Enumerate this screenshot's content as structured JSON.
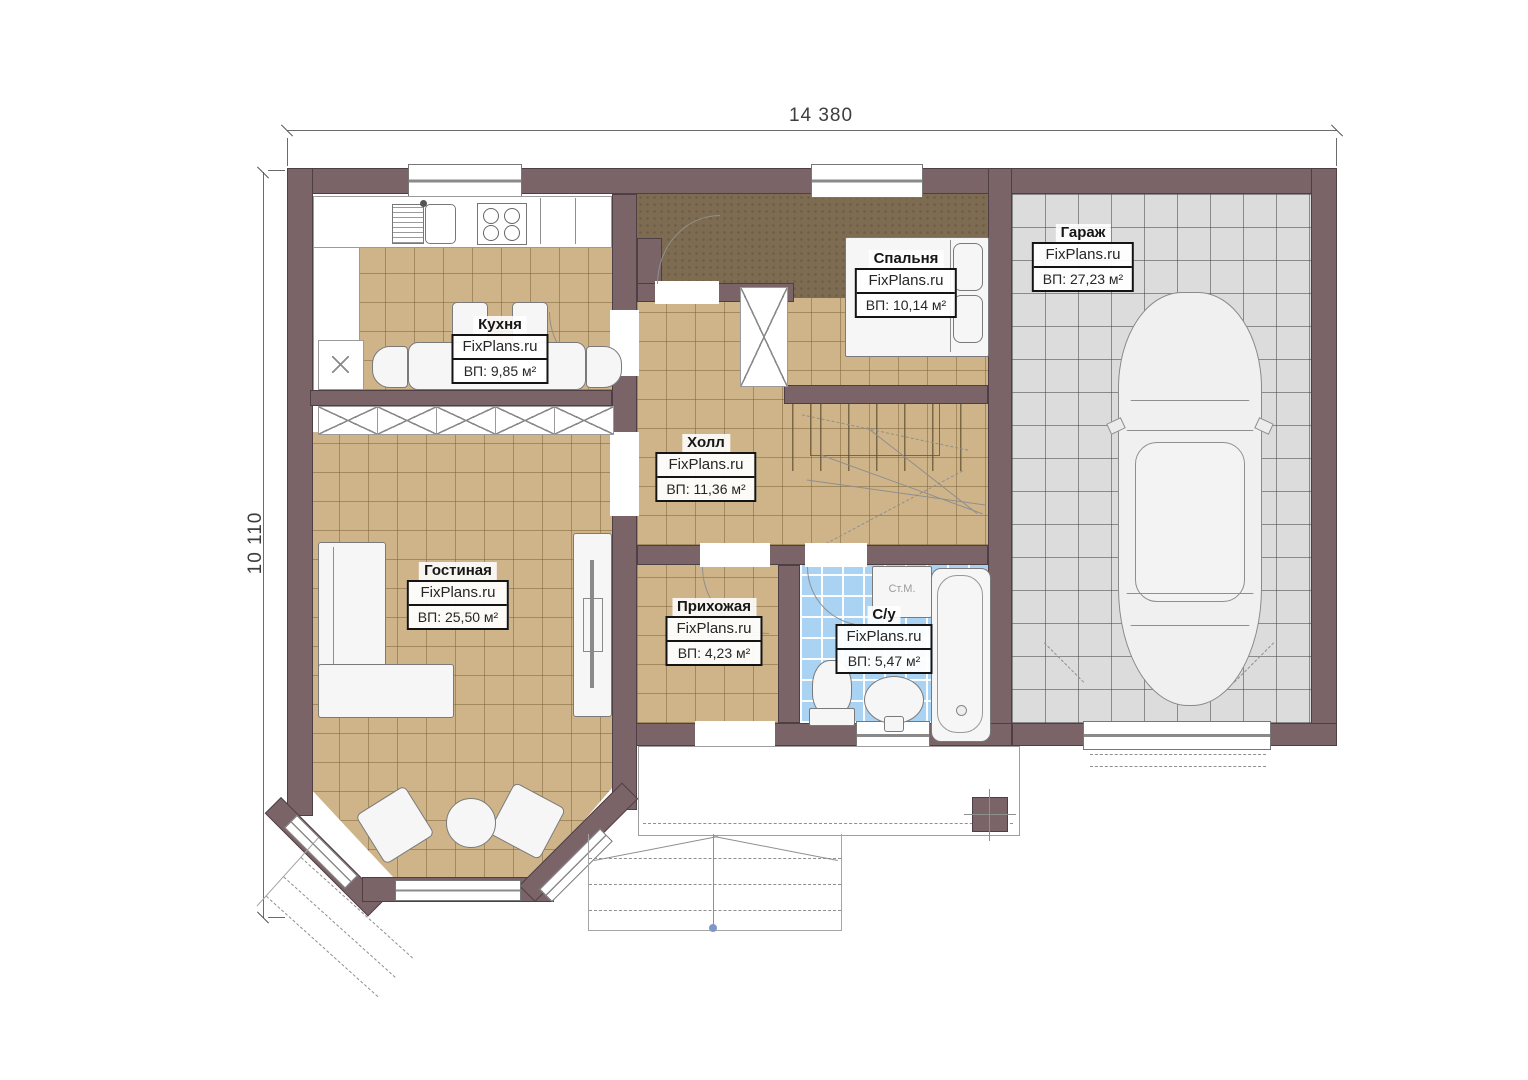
{
  "dims": {
    "width": "14 380",
    "height": "10 110"
  },
  "watermark": "FixPlans.ru",
  "rooms": {
    "kitchen": {
      "name": "Кухня",
      "brand": "FixPlans.ru",
      "area": "ВП: 9,85 м²"
    },
    "living": {
      "name": "Гостиная",
      "brand": "FixPlans.ru",
      "area": "ВП: 25,50 м²"
    },
    "hall": {
      "name": "Холл",
      "brand": "FixPlans.ru",
      "area": "ВП: 11,36 м²"
    },
    "bedroom": {
      "name": "Спальня",
      "brand": "FixPlans.ru",
      "area": "ВП: 10,14 м²"
    },
    "entry": {
      "name": "Прихожая",
      "brand": "FixPlans.ru",
      "area": "ВП: 4,23 м²"
    },
    "bath": {
      "name": "С/у",
      "brand": "FixPlans.ru",
      "area": "ВП: 5,47 м²"
    },
    "garage": {
      "name": "Гараж",
      "brand": "FixPlans.ru",
      "area": "ВП: 27,23 м²"
    }
  },
  "fixtures": {
    "washing_machine": "Ст.М."
  },
  "colors": {
    "wall": "#7b6468",
    "floor_tile_tan": "#cfb489",
    "floor_bedroom": "#7e6c52",
    "floor_garage": "#dcdcdc",
    "floor_bath": "#a9d2f3",
    "label_border": "#141414"
  }
}
